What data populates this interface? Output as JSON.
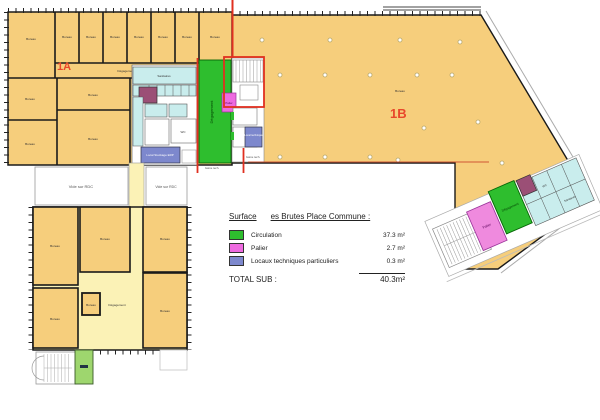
{
  "colors": {
    "office": "#f6ce7c",
    "corridor": "#fbf2b6",
    "circulation": "#2ebe2e",
    "palier": "#ee6ae0",
    "palier_light": "#ef8ade",
    "locaux": "#7d88cd",
    "sanitary": "#c9eded",
    "technique_dark": "#9b4f76",
    "green_room": "#9ed66e",
    "zone_label": "#e8472b",
    "red_boundary": "#e03020"
  },
  "zones": {
    "a": "1A",
    "b": "1B"
  },
  "rooms": {
    "bureau": "Bureau",
    "degagement": "Dégagement",
    "vide_rdc": "Vide sur RDC",
    "palier": "Palier",
    "local_technique": "Local technique",
    "local_stockage": "Local Stockage ERP",
    "sanitaires": "Sanitaires",
    "wc": "WC",
    "gaine": "Gaine tech."
  },
  "legend": {
    "title_left": "Surface",
    "title_right": "es Brutes Place Commune :",
    "items": [
      {
        "label": "Circulation",
        "value": "37.3 m²",
        "color": "#2ebe2e"
      },
      {
        "label": "Palier",
        "value": "2.7 m²",
        "color": "#ee6ae0"
      },
      {
        "label": "Locaux techniques particuliers",
        "value": "0.3 m²",
        "color": "#7d88cd"
      }
    ],
    "total_label": "TOTAL SUB :",
    "total_value": "40.3m²"
  }
}
